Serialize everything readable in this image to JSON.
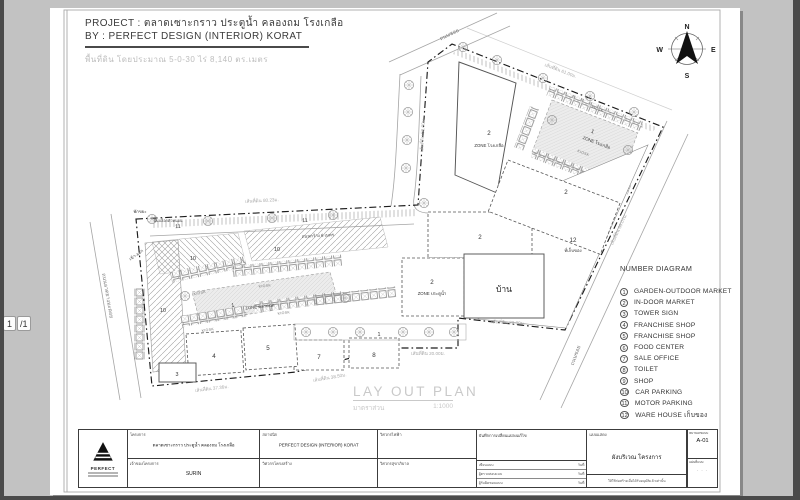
{
  "viewer": {
    "page_current": "1",
    "page_total": "/1"
  },
  "header": {
    "project_label": "PROJECT :",
    "project_name": "ตลาดเซาะกราว ประตูน้ำ คลองถม โรงเกลือ",
    "by_label": "BY :",
    "by_name": "PERFECT DESIGN (INTERIOR) KORAT",
    "area_note": "พื้นที่ดิน โดยประมาณ 5-0-30 ไร่   8,140   ตร.เมตร"
  },
  "compass": {
    "n": "N",
    "e": "E",
    "s": "S",
    "w": "W"
  },
  "plan": {
    "road_soi": "ถนนซอย",
    "road_asphalt": "ถนนลาดยางมะตอย",
    "road_width": "ถนนกว้าง 6 เมตร",
    "dim_80": "เส้นที่ดิน 80.23ม.",
    "dim_53": "เส้นที่ดิน 53.00ม.",
    "dim_61": "เส้นที่ดิน 61.00ม.",
    "dim_68": "เส้นที่ดิน 68.07ม.",
    "dim_23": "เส้นที่ดิน 23.00ม.",
    "dim_20": "เส้นที่ดิน 20.00ม.",
    "dim_3850": "เส้นที่ดิน 38.50ม.",
    "dim_3736": "เส้นที่ดิน 37.36ม.",
    "zone_rongkluea": "ZONE โรงเกลือ",
    "zone_pratunam": "ZONE ประตูน้ำ",
    "zone_taladnat": "ZONE ตลาดนัด",
    "kiosk": "KIOSK",
    "house": "บ้าน",
    "storage": "ที่เก็บของ",
    "waste": "พักขยะ",
    "paving": "พื้นบล็อกตัวหนอน",
    "gate": "เข้า-ออก",
    "n1": "1",
    "n2": "2",
    "n3": "3",
    "n4": "4",
    "n5": "5",
    "n7": "7",
    "n8": "8",
    "n10": "10",
    "n11": "11",
    "n12": "12"
  },
  "plan_title": {
    "text": "LAY OUT PLAN",
    "scale_label": "มาตราส่วน",
    "scale_value": "1:1000"
  },
  "legend": {
    "title": "NUMBER DIAGRAM",
    "items": [
      {
        "num": "1",
        "label": "GARDEN-OUTDOOR MARKET"
      },
      {
        "num": "2",
        "label": "IN-DOOR MARKET"
      },
      {
        "num": "3",
        "label": "TOWER SIGN"
      },
      {
        "num": "4",
        "label": "FRANCHISE SHOP"
      },
      {
        "num": "5",
        "label": "FRANCHISE SHOP"
      },
      {
        "num": "6",
        "label": "FOOD CENTER"
      },
      {
        "num": "7",
        "label": "SALE OFFICE"
      },
      {
        "num": "8",
        "label": "TOILET"
      },
      {
        "num": "9",
        "label": "SHOP"
      },
      {
        "num": "10",
        "label": "CAR PARKING"
      },
      {
        "num": "11",
        "label": "MOTOR PARKING"
      },
      {
        "num": "12",
        "label": "WARE HOUSE เก็บของ"
      }
    ]
  },
  "titleblock": {
    "logo_text": "PERFECT",
    "project_label": "โครงการ",
    "project_value": "ตลาดเซาะกราว ประตูน้ำ คลองถม โรงเกลือ",
    "owner_label": "เจ้าของโครงการ",
    "owner_value": "SURIN",
    "architect_label": "สถาปนิก",
    "architect_value": "PERFECT DESIGN   (INTERIOR) KORAT",
    "struct_label": "วิศวกรโครงสร้าง",
    "elec_label": "วิศวกรไฟฟ้า",
    "sani_label": "วิศวกรสุขาภิบาล",
    "revision_label": "บันทึกการเปลี่ยนแปลงแก้ไข",
    "rev_rows": [
      {
        "k": "เขียนแบบ",
        "v": "วันที่"
      },
      {
        "k": "ผู้ตรวจสอบแบบ",
        "v": "วันที่"
      },
      {
        "k": "ผู้รับผิดชอบแบบ",
        "v": "วันที่"
      }
    ],
    "drawing_label": "แบบแสดง",
    "drawing_value": "ผังบริเวณ โครงการ",
    "drawing_note": "ให้ใช้ก่อสร้างเมื่อได้รับอนุมัติแล้วเท่านั้น",
    "sheet_no_label": "หมายเลขแบบ",
    "sheet_no_value": "A-01",
    "sheet_label": "แผ่นที่แบบ",
    "sheet_value": "- - -"
  }
}
